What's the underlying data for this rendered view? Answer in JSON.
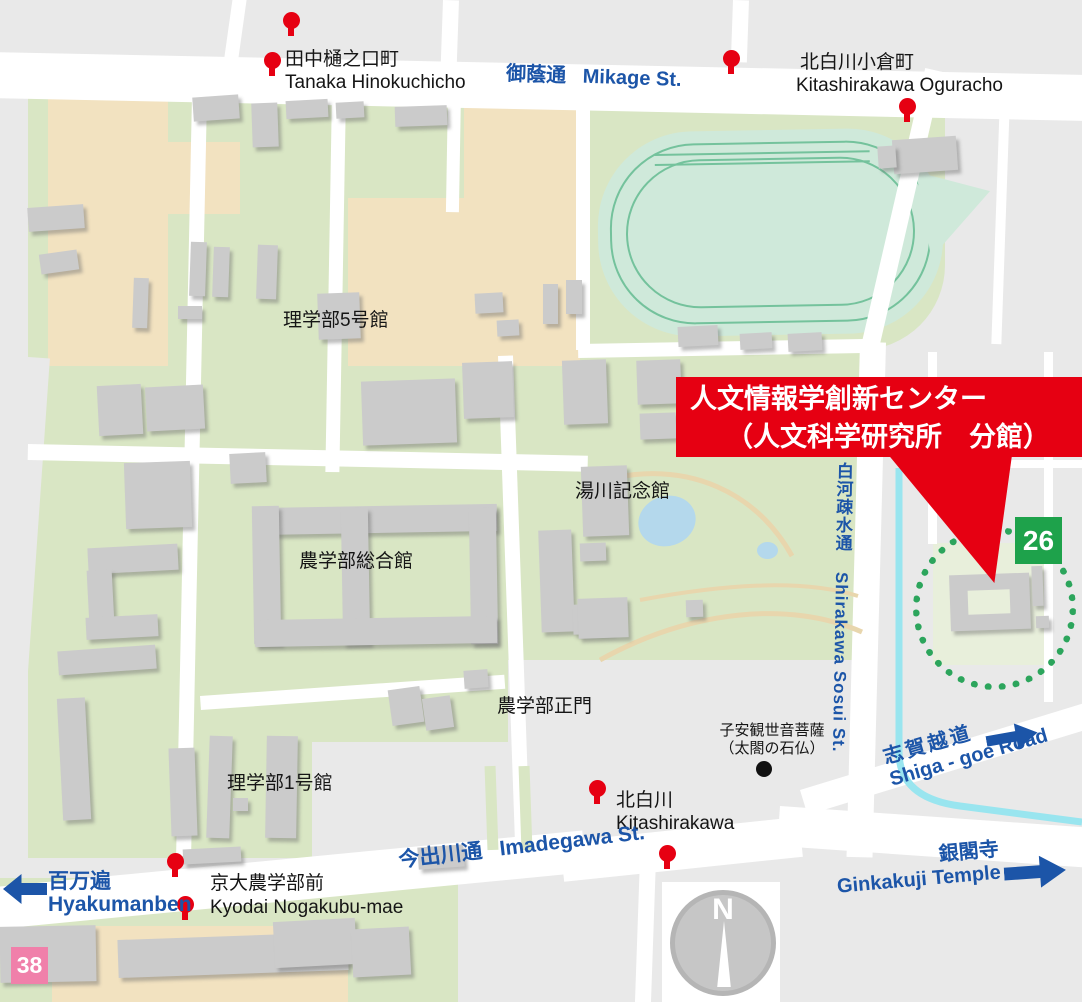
{
  "banner": {
    "line1": "人文情報学創新センター",
    "line2": "（人文科学研究所　分館）"
  },
  "badges": {
    "building26": "26",
    "building38": "38"
  },
  "compass": {
    "north": "N"
  },
  "streets": {
    "mikage": {
      "ja": "御蔭通",
      "en": "Mikage St."
    },
    "imadegawa": {
      "ja": "今出川通",
      "en": "Imadegawa St."
    },
    "shirakawa_sosui": {
      "ja": "白河疎水通",
      "en": "Shirakawa Sosui St."
    },
    "shiga_goe": {
      "ja": "志賀越道",
      "en": "Shiga - goe Road"
    }
  },
  "bus_stops": {
    "tanaka": {
      "ja": "田中樋之口町",
      "en": "Tanaka Hinokuchicho"
    },
    "oguracho": {
      "ja": "北白川小倉町",
      "en": "Kitashirakawa Oguracho"
    },
    "kitashirakawa": {
      "ja": "北白川",
      "en": "Kitashirakawa"
    },
    "nogakubu_mae": {
      "ja": "京大農学部前",
      "en": "Kyodai Nogakubu-mae"
    }
  },
  "destinations": {
    "hyakumanben": {
      "ja": "百万遍",
      "en": "Hyakumanben"
    },
    "ginkakuji": {
      "ja": "銀閣寺",
      "en": "Ginkakuji Temple"
    }
  },
  "campus_labels": {
    "rigakubu5": "理学部5号館",
    "yukawa": "湯川記念館",
    "nogakubu_sogo": "農学部総合館",
    "nogakubu_seimon": "農学部正門",
    "rigakubu1": "理学部1号館"
  },
  "landmark": {
    "line1": "子安観世音菩薩",
    "line2": "（太閤の石仏）"
  },
  "colors": {
    "accent_red": "#e60012",
    "street_blue": "#1c55a8",
    "badge_green": "#1ea24b",
    "badge_pink": "#f080aa",
    "canal_cyan": "#99e5ef",
    "campus_green": "#d9e6c4",
    "field_tan": "#f2e2c0",
    "track_mint": "#cfe9da"
  }
}
